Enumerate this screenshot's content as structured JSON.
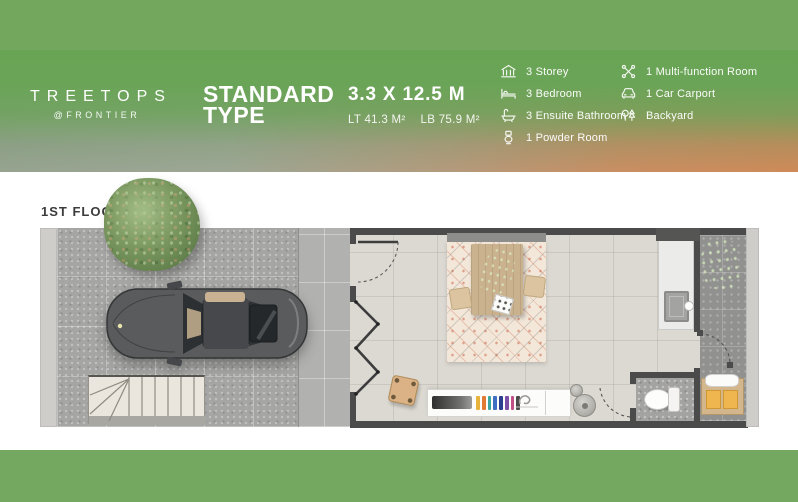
{
  "header": {
    "logo_name": "TREETOPS",
    "logo_sub": "@FRONTIER",
    "type_line1": "STANDARD",
    "type_line2": "TYPE",
    "dimensions": {
      "size": "3.3 X 12.5 M",
      "lt": "LT 41.3 M²",
      "lb": "LB 75.9 M²"
    },
    "specs_left": [
      {
        "icon": "building-icon",
        "label": "3 Storey"
      },
      {
        "icon": "bed-icon",
        "label": "3 Bedroom"
      },
      {
        "icon": "bath-icon",
        "label": "3 Ensuite Bathroom"
      },
      {
        "icon": "toilet-icon",
        "label": "1 Powder Room"
      }
    ],
    "specs_right": [
      {
        "icon": "tools-icon",
        "label": "1 Multi-function Room"
      },
      {
        "icon": "car-icon",
        "label": "1 Car Carport"
      },
      {
        "icon": "trees-icon",
        "label": "Backyard"
      }
    ]
  },
  "plan": {
    "floor_label": "1ST FLOOR",
    "features": [
      "tree",
      "carport-paving",
      "car",
      "staircase",
      "entrance-door",
      "folding-door",
      "dining-table",
      "rug",
      "stool",
      "kitchen-counter",
      "sink-counter",
      "powder-room",
      "toilet",
      "backyard",
      "yard-cabinet"
    ]
  },
  "colors": {
    "brand_green": "#72a75d",
    "header_orange": "#cf8a58",
    "wall": "#4b4b4b",
    "interior_floor": "#dcd9d2",
    "paving": "#a5a5a3",
    "rug": "#f2e7d9",
    "cabinet_yellow": "#efb54f"
  }
}
